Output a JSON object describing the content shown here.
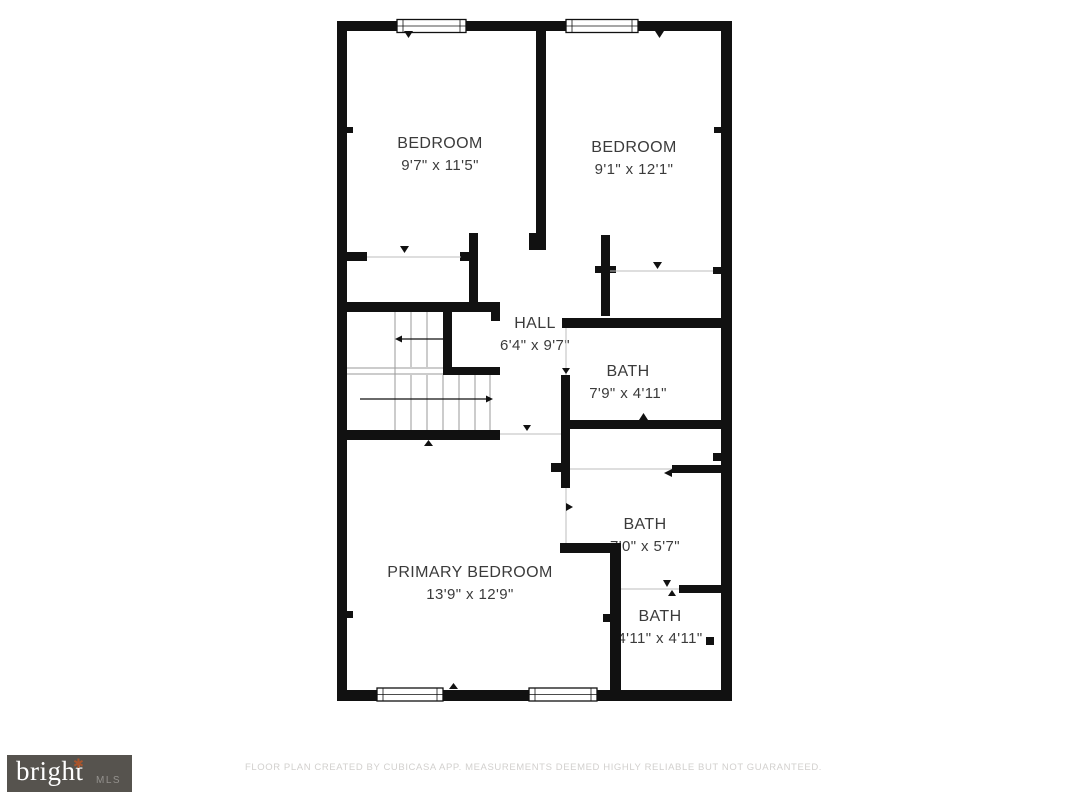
{
  "plan": {
    "rooms": [
      {
        "name": "BEDROOM",
        "dims": "9'7\" x 11'5\""
      },
      {
        "name": "BEDROOM",
        "dims": "9'1\" x 12'1\""
      },
      {
        "name": "HALL",
        "dims": "6'4\" x 9'7\""
      },
      {
        "name": "BATH",
        "dims": "7'9\" x 4'11\""
      },
      {
        "name": "BATH",
        "dims": "7'0\" x 5'7\""
      },
      {
        "name": "PRIMARY BEDROOM",
        "dims": "13'9\" x 12'9\""
      },
      {
        "name": "BATH",
        "dims": "4'11\" x 4'11\""
      }
    ]
  },
  "branding": {
    "logo_text": "bright",
    "logo_suffix": "MLS",
    "logo_star_glyph": "✱"
  },
  "footer": {
    "disclaimer": "FLOOR PLAN CREATED BY CUBICASA APP. MEASUREMENTS DEEMED HIGHLY RELIABLE BUT NOT GUARANTEED."
  },
  "colors": {
    "wall": "#111111",
    "label_text": "#3b3b3b",
    "logo_background": "#56534e",
    "logo_star": "#a8542c",
    "disclaimer_text": "#d2d0ce"
  }
}
